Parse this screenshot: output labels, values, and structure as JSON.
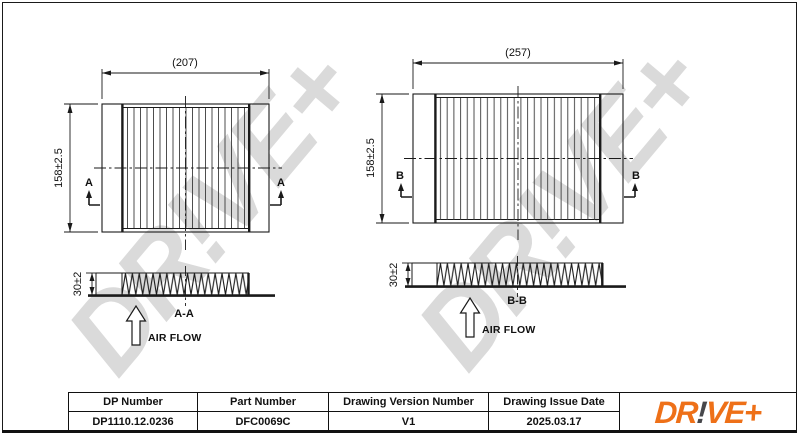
{
  "drawing": {
    "watermark": "DR!VE+",
    "left": {
      "width_dim": "(207)",
      "height_dim": "158±2.5",
      "depth_dim": "30±2",
      "section_label": "A",
      "section_title": "A-A",
      "airflow_label": "AIR FLOW"
    },
    "right": {
      "width_dim": "(257)",
      "height_dim": "158±2.5",
      "depth_dim": "30±2",
      "section_label": "B",
      "section_title": "B-B",
      "airflow_label": "AIR FLOW"
    }
  },
  "table": {
    "headers": [
      "DP Number",
      "Part Number",
      "Drawing Version Number",
      "Drawing Issue Date"
    ],
    "values": [
      "DP1110.12.0236",
      "DFC0069C",
      "V1",
      "2025.03.17"
    ]
  },
  "logo": {
    "prefix": "DR",
    "bang": "!",
    "suffix": "VE+"
  },
  "colors": {
    "logo_orange": "#ee7018",
    "logo_dark": "#47474b",
    "watermark_gray": "#dadada",
    "line_black": "#1a1a1a"
  }
}
